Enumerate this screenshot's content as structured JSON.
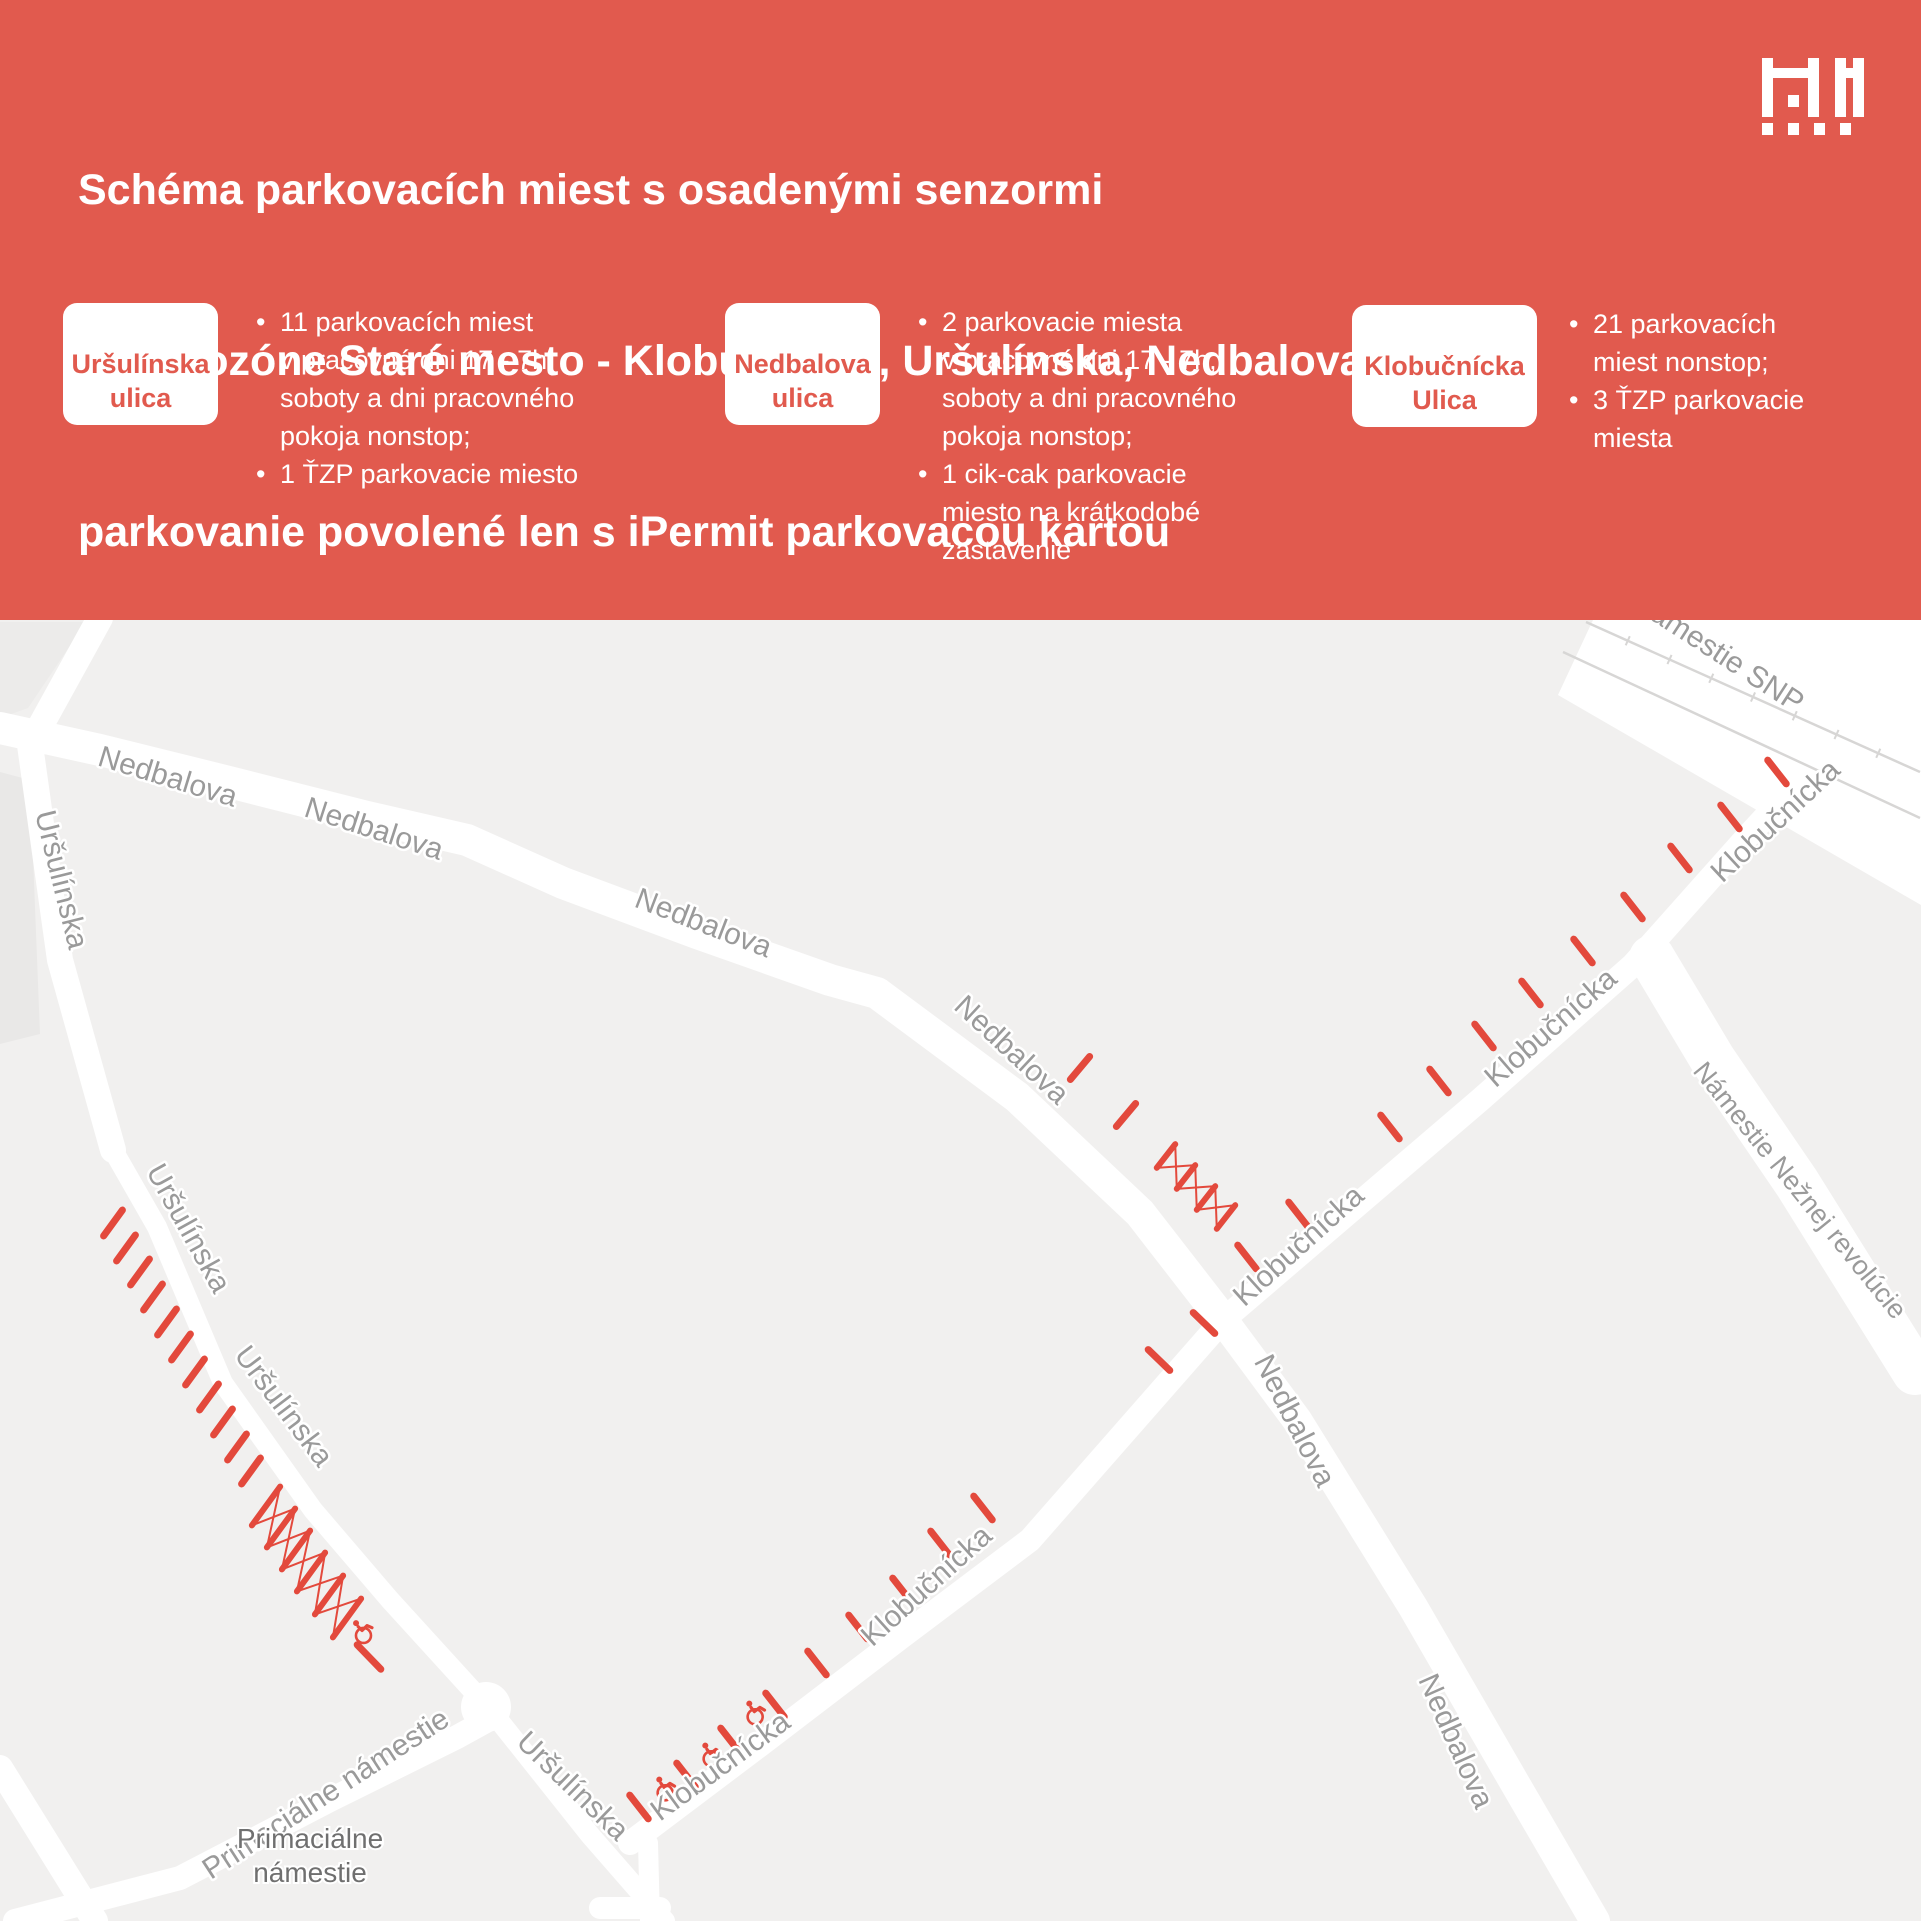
{
  "header": {
    "background": "#E15A4E",
    "text_color": "#FFFFFF",
    "title_lines": [
      "Schéma parkovacích miest s osadenými senzormi",
      "v Mikrozóne Staré mesto - Klobučnícka, Uršulínska, Nedbalova",
      "parkovanie povolené len s iPermit parkovacou kartou"
    ],
    "logo_name": "bratislava-city-logo"
  },
  "legend": [
    {
      "street": [
        "Uršulínska",
        "ulica"
      ],
      "badge_text_color": "#E15A4E",
      "bullets": [
        [
          "11 parkovacích miest",
          "v pracovné dni 17 - 7h,",
          "soboty a dni pracovného",
          "pokoja nonstop;"
        ],
        [
          "1 ŤZP parkovacie miesto"
        ]
      ]
    },
    {
      "street": [
        "Nedbalova",
        "ulica"
      ],
      "badge_text_color": "#E15A4E",
      "bullets": [
        [
          "2 parkovacie miesta",
          "v pracovné dni 17 - 7h,",
          "soboty a dni pracovného",
          "pokoja nonstop;"
        ],
        [
          "1 cik-cak parkovacie",
          "miesto na krátkodobé",
          "zastavenie"
        ]
      ]
    },
    {
      "street": [
        "Klobučnícka",
        "Ulica"
      ],
      "badge_text_color": "#E15A4E",
      "bullets": [
        [
          "21 parkovacích",
          "miest nonstop;"
        ],
        [
          "3 ŤZP parkovacie",
          "miesta"
        ]
      ]
    }
  ],
  "map": {
    "view_y": 620,
    "width": 1921,
    "height": 1301,
    "colors": {
      "background": "#F1F0EF",
      "street": "#FFFFFF",
      "label": "#9A9A9A",
      "label_halo": "#FFFFFF",
      "place_label": "#6F6F6F",
      "marker": "#E3493C",
      "tram": "#D7D6D5"
    },
    "buildings": [
      {
        "fill": "#E9E8E7",
        "pts": [
          [
            0,
            772
          ],
          [
            30,
            780
          ],
          [
            40,
            1034
          ],
          [
            0,
            1044
          ]
        ]
      },
      {
        "fill": "#ECEBEA",
        "pts": [
          [
            0,
            622
          ],
          [
            86,
            622
          ],
          [
            28,
            708
          ],
          [
            0,
            718
          ]
        ]
      }
    ],
    "plaza": [
      [
        1593,
        620
      ],
      [
        1921,
        620
      ],
      [
        1921,
        905
      ],
      [
        1558,
        695
      ]
    ],
    "streets": [
      {
        "name": "ursulinska-north",
        "w": 26,
        "pts": [
          [
            100,
            618
          ],
          [
            30,
            745
          ],
          [
            60,
            960
          ],
          [
            113,
            1150
          ]
        ]
      },
      {
        "name": "ursulinska-south",
        "w": 20,
        "pts": [
          [
            113,
            1150
          ],
          [
            157,
            1227
          ],
          [
            223,
            1383
          ],
          [
            313,
            1510
          ],
          [
            390,
            1600
          ],
          [
            493,
            1713
          ],
          [
            590,
            1835
          ],
          [
            665,
            1921
          ]
        ]
      },
      {
        "name": "nedbalova-west",
        "w": 32,
        "pts": [
          [
            0,
            728
          ],
          [
            100,
            750
          ],
          [
            233,
            783
          ],
          [
            367,
            817
          ],
          [
            467,
            840
          ],
          [
            563,
            883
          ],
          [
            697,
            933
          ],
          [
            830,
            980
          ],
          [
            877,
            993
          ],
          [
            1017,
            1097
          ],
          [
            1140,
            1213
          ],
          [
            1223,
            1320
          ]
        ]
      },
      {
        "name": "nedbalova-south",
        "w": 30,
        "pts": [
          [
            1223,
            1320
          ],
          [
            1297,
            1420
          ],
          [
            1413,
            1607
          ],
          [
            1513,
            1780
          ],
          [
            1595,
            1921
          ]
        ]
      },
      {
        "name": "klobucnicka",
        "w": 24,
        "pts": [
          [
            630,
            1843
          ],
          [
            760,
            1745
          ],
          [
            900,
            1638
          ],
          [
            1030,
            1540
          ],
          [
            1223,
            1320
          ],
          [
            1480,
            1100
          ],
          [
            1633,
            965
          ],
          [
            1747,
            837
          ],
          [
            1880,
            693
          ]
        ]
      },
      {
        "name": "klobucnicka-stub",
        "w": 20,
        "pts": [
          [
            648,
            1843
          ],
          [
            650,
            1921
          ]
        ]
      },
      {
        "name": "side-alley",
        "w": 22,
        "pts": [
          [
            600,
            1908
          ],
          [
            660,
            1908
          ]
        ]
      },
      {
        "name": "primacialne-street",
        "w": 24,
        "pts": [
          [
            15,
            1921
          ],
          [
            180,
            1878
          ],
          [
            330,
            1800
          ],
          [
            457,
            1737
          ],
          [
            497,
            1715
          ]
        ]
      },
      {
        "name": "corner-street",
        "w": 26,
        "pts": [
          [
            0,
            1768
          ],
          [
            95,
            1921
          ]
        ]
      },
      {
        "name": "nam-neznej-revolucie",
        "w": 46,
        "pts": [
          [
            1652,
            958
          ],
          [
            1713,
            1060
          ],
          [
            1797,
            1183
          ],
          [
            1915,
            1372
          ]
        ]
      }
    ],
    "junction_bulge": {
      "x": 486,
      "y": 1707,
      "r": 25
    },
    "tram_lines": [
      {
        "pts": [
          [
            1586,
            622
          ],
          [
            1920,
            772
          ]
        ],
        "ticks": 7
      },
      {
        "pts": [
          [
            1563,
            652
          ],
          [
            1920,
            818
          ]
        ],
        "ticks": 0
      }
    ],
    "parking_groups": [
      {
        "name": "ursulinska-parking-dashes",
        "angle": -54,
        "len": 32,
        "width": 7,
        "points": [
          [
            113,
            1223
          ],
          [
            126,
            1248
          ],
          [
            140,
            1272
          ],
          [
            153,
            1297
          ],
          [
            167,
            1322
          ],
          [
            181,
            1347
          ],
          [
            195,
            1372
          ],
          [
            209,
            1397
          ],
          [
            223,
            1422
          ],
          [
            237,
            1447
          ],
          [
            251,
            1471
          ]
        ]
      },
      {
        "name": "ursulinska-end-dash",
        "angle": 46,
        "len": 34,
        "width": 7,
        "points": [
          [
            369,
            1657
          ]
        ]
      },
      {
        "name": "nedbalova-parking-dashes",
        "angle": -50,
        "len": 30,
        "width": 7,
        "points": [
          [
            1080,
            1068
          ],
          [
            1126,
            1115
          ]
        ]
      },
      {
        "name": "nedbalova-south-dashes",
        "angle": 44,
        "len": 30,
        "width": 7,
        "points": [
          [
            1204,
            1323
          ],
          [
            1159,
            1360
          ]
        ]
      },
      {
        "name": "klobucnicka-sw-dashes",
        "angle": 52,
        "len": 30,
        "width": 7,
        "points": [
          [
            639,
            1807
          ],
          [
            686,
            1775
          ],
          [
            730,
            1740
          ],
          [
            775,
            1705
          ],
          [
            817,
            1663
          ],
          [
            858,
            1627
          ],
          [
            902,
            1590
          ],
          [
            940,
            1543
          ],
          [
            983,
            1508
          ]
        ]
      },
      {
        "name": "klobucnicka-ne-dashes",
        "angle": 52,
        "len": 30,
        "width": 7,
        "points": [
          [
            1247,
            1257
          ],
          [
            1298,
            1214
          ],
          [
            1390,
            1127
          ],
          [
            1439,
            1081
          ],
          [
            1484,
            1036
          ],
          [
            1531,
            993
          ],
          [
            1583,
            951
          ],
          [
            1633,
            907
          ],
          [
            1680,
            858
          ],
          [
            1730,
            817
          ],
          [
            1777,
            772
          ]
        ]
      }
    ],
    "zigzags": [
      {
        "name": "ursulinska-cikcak",
        "angle": -54,
        "len": 48,
        "width": 6,
        "thin": 2,
        "centers": [
          [
            266,
            1506
          ],
          [
            281,
            1528
          ],
          [
            296,
            1550
          ],
          [
            311,
            1572
          ],
          [
            329,
            1595
          ],
          [
            347,
            1618
          ]
        ]
      },
      {
        "name": "nedbalova-cikcak",
        "angle": -52,
        "len": 30,
        "width": 6,
        "thin": 2,
        "centers": [
          [
            1166,
            1156
          ],
          [
            1186,
            1177
          ],
          [
            1206,
            1198
          ],
          [
            1226,
            1217
          ]
        ]
      }
    ],
    "wheelchairs": [
      {
        "x": 753,
        "y": 1714,
        "rot": -38
      },
      {
        "x": 709,
        "y": 1756,
        "rot": -38
      },
      {
        "x": 663,
        "y": 1790,
        "rot": -38
      },
      {
        "x": 361,
        "y": 1633,
        "rot": -45
      }
    ],
    "labels": [
      {
        "t": "Nedbalova",
        "x": 165,
        "y": 786,
        "r": 17
      },
      {
        "t": "Nedbalova",
        "x": 371,
        "y": 838,
        "r": 18
      },
      {
        "t": "Nedbalova",
        "x": 700,
        "y": 932,
        "r": 21
      },
      {
        "t": "Nedbalova",
        "x": 1005,
        "y": 1057,
        "r": 43
      },
      {
        "t": "Nedbalova",
        "x": 1286,
        "y": 1425,
        "r": 63
      },
      {
        "t": "Nedbalova",
        "x": 1447,
        "y": 1745,
        "r": 66
      },
      {
        "t": "Uršulínska",
        "x": 52,
        "y": 882,
        "r": 76
      },
      {
        "t": "Uršulínska",
        "x": 180,
        "y": 1233,
        "r": 61
      },
      {
        "t": "Uršulínska",
        "x": 276,
        "y": 1412,
        "r": 53
      },
      {
        "t": "Uršulínska",
        "x": 566,
        "y": 1793,
        "r": 44
      },
      {
        "t": "Klobučnícka",
        "x": 726,
        "y": 1774,
        "r": -36
      },
      {
        "t": "Klobučnícka",
        "x": 933,
        "y": 1593,
        "r": -42
      },
      {
        "t": "Klobučnícka",
        "x": 1305,
        "y": 1253,
        "r": -42
      },
      {
        "t": "Klobučnícka",
        "x": 1557,
        "y": 1035,
        "r": -41
      },
      {
        "t": "Klobučnícka",
        "x": 1782,
        "y": 828,
        "r": -43
      },
      {
        "t": "Primaciálne námestie",
        "x": 331,
        "y": 1802,
        "r": -33
      },
      {
        "t": "Námestie SNP",
        "x": 1713,
        "y": 660,
        "r": 33
      },
      {
        "t": "Námestie Nežnej revolúcie",
        "x": 1793,
        "y": 1196,
        "r": 51,
        "s": 27
      }
    ],
    "place_label": {
      "lines": [
        "Primaciálne",
        "námestie"
      ],
      "x": 310,
      "y": 1848,
      "size": 28
    }
  }
}
